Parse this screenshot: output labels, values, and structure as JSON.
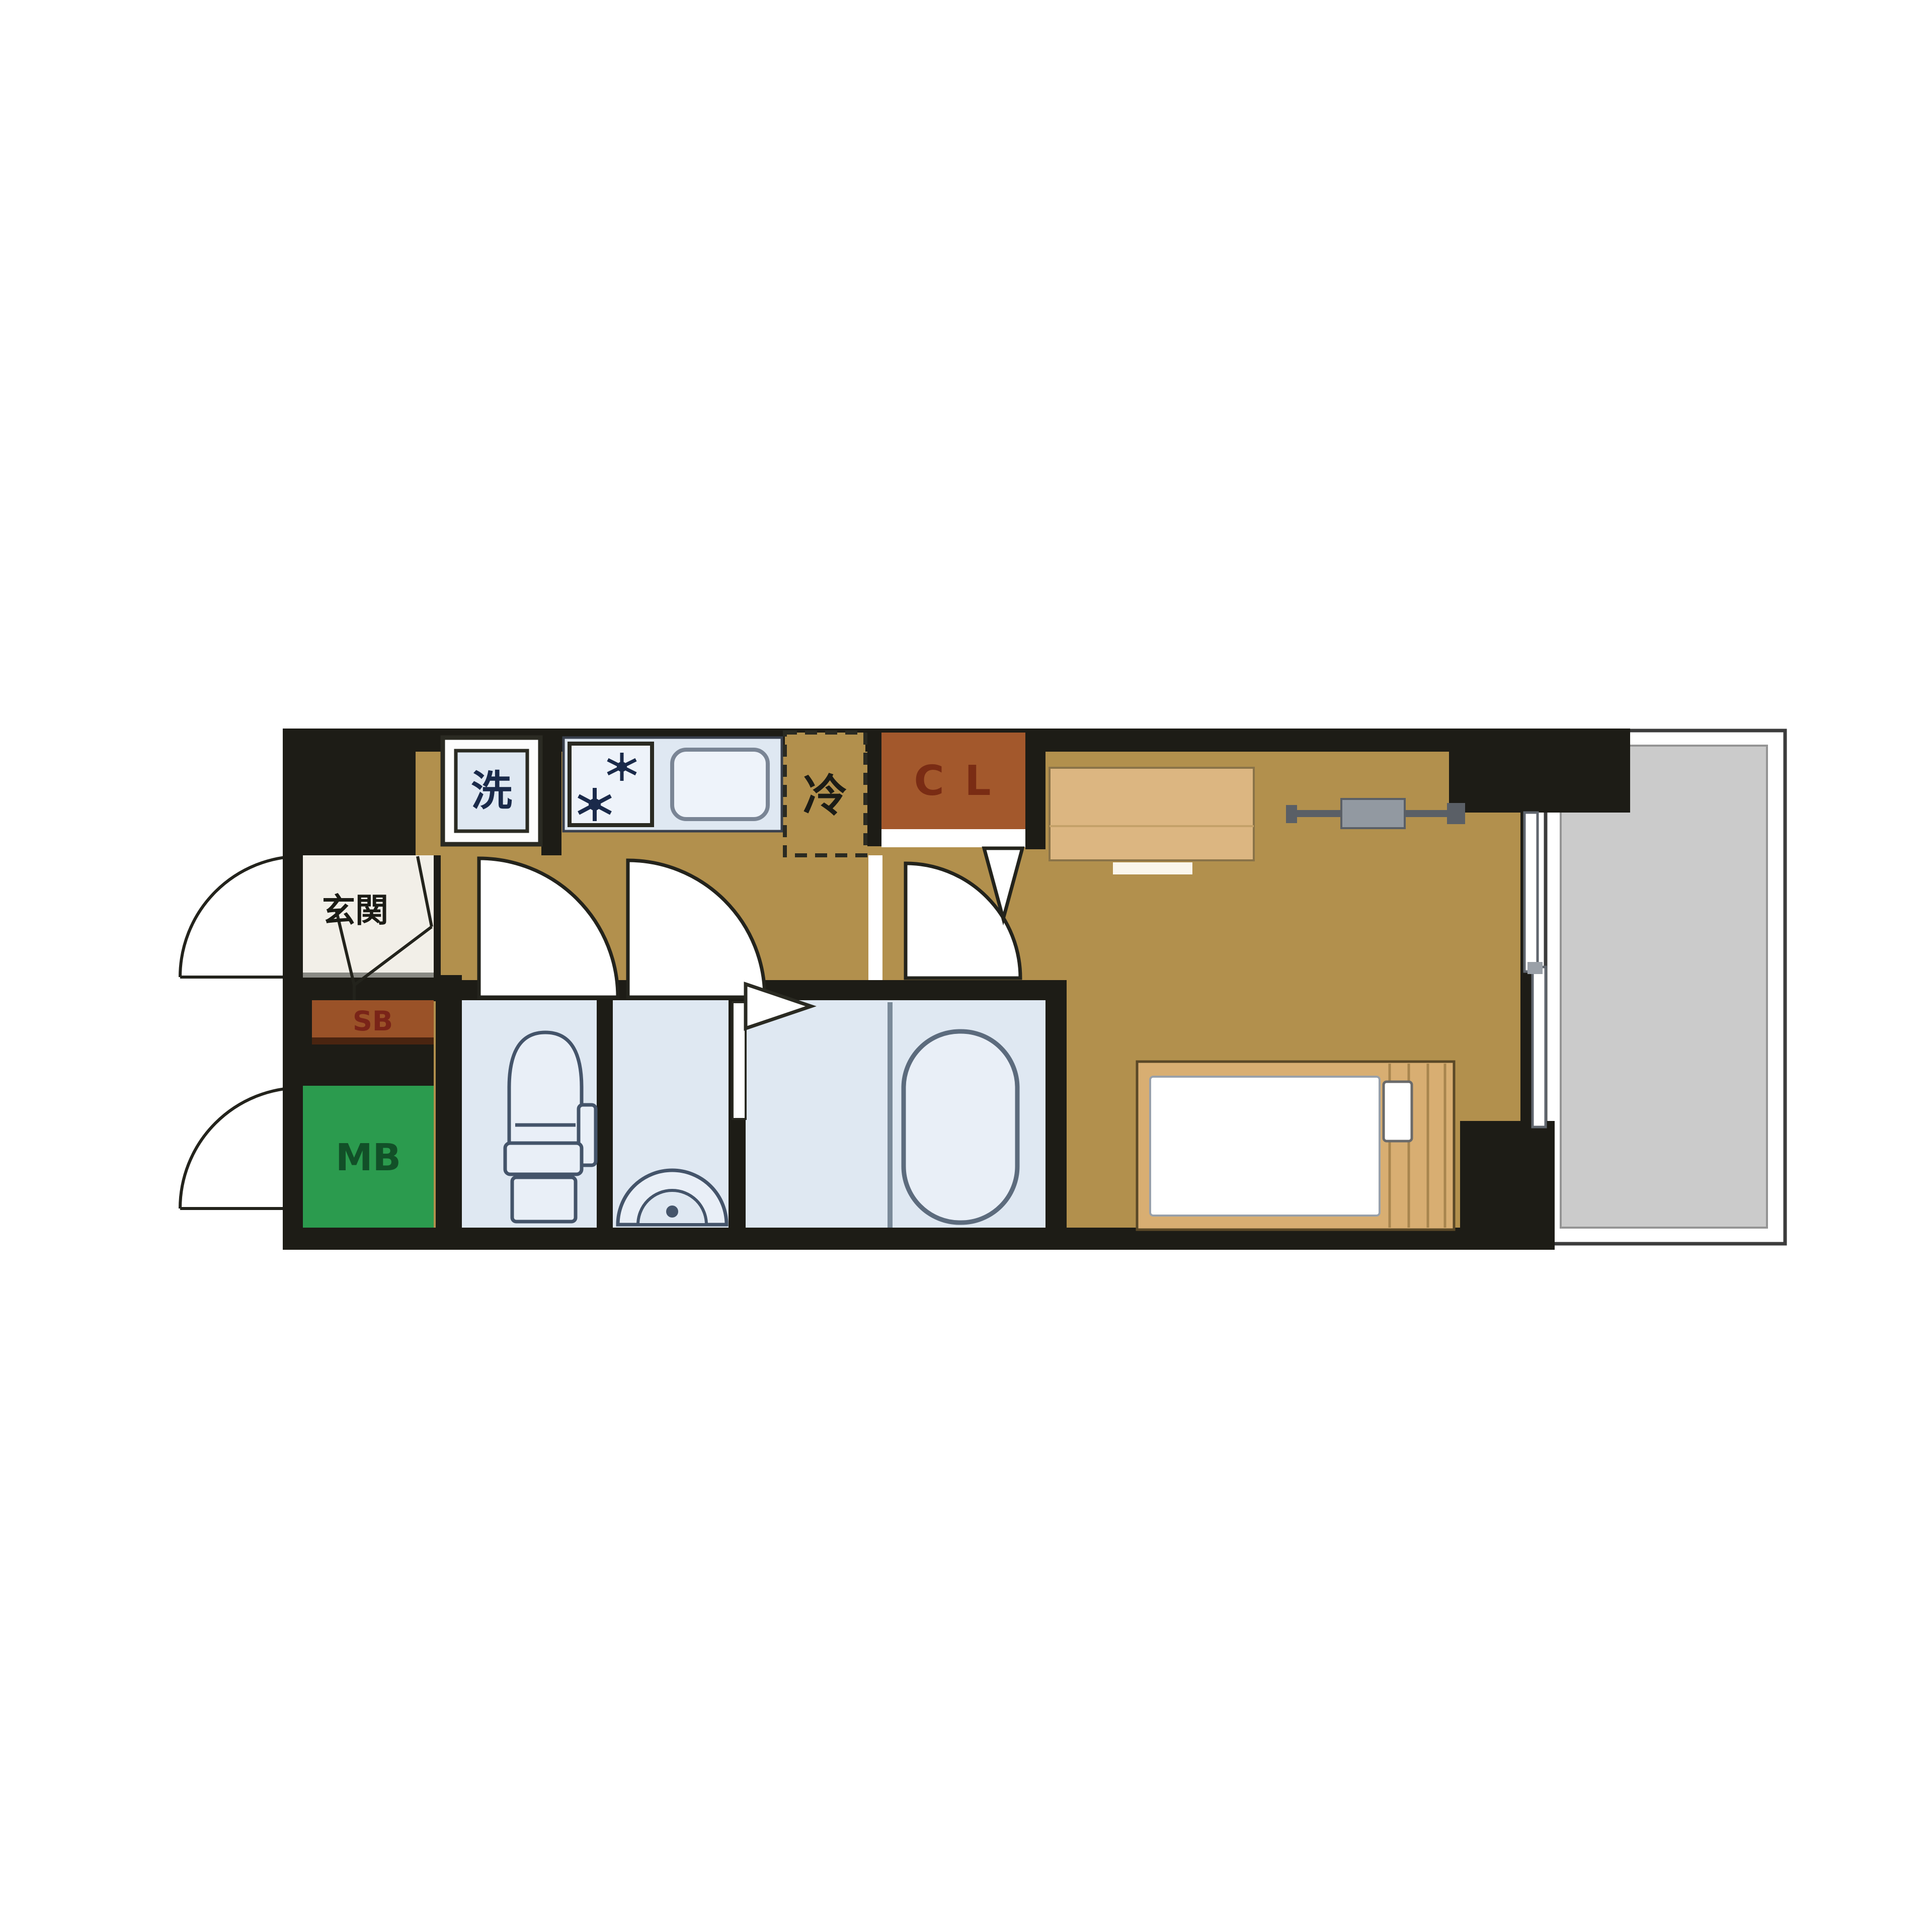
{
  "floor_plan": {
    "type": "japanese-1K-apartment-floor-plan",
    "labels": {
      "entrance": "玄関",
      "shoe_box": "SB",
      "meter_box": "MB",
      "washing_machine": "洗",
      "refrigerator": "冷",
      "closet": "C L"
    },
    "colors": {
      "wall_black": "#1d1c16",
      "floor_tan": "#b2904d",
      "sanitary_blue": "#dfe8f2",
      "entrance_cream": "#f2efe8",
      "shoe_box_brown": "#9a5228",
      "closet_brown": "#a3582c",
      "closet_text": "#7a2c14",
      "meter_box_green": "#2b9b4e",
      "meter_box_text": "#125028",
      "balcony_gray": "#cbcbcb",
      "wood_light": "#d8ae72",
      "fixture_stroke": "#44546a"
    }
  }
}
